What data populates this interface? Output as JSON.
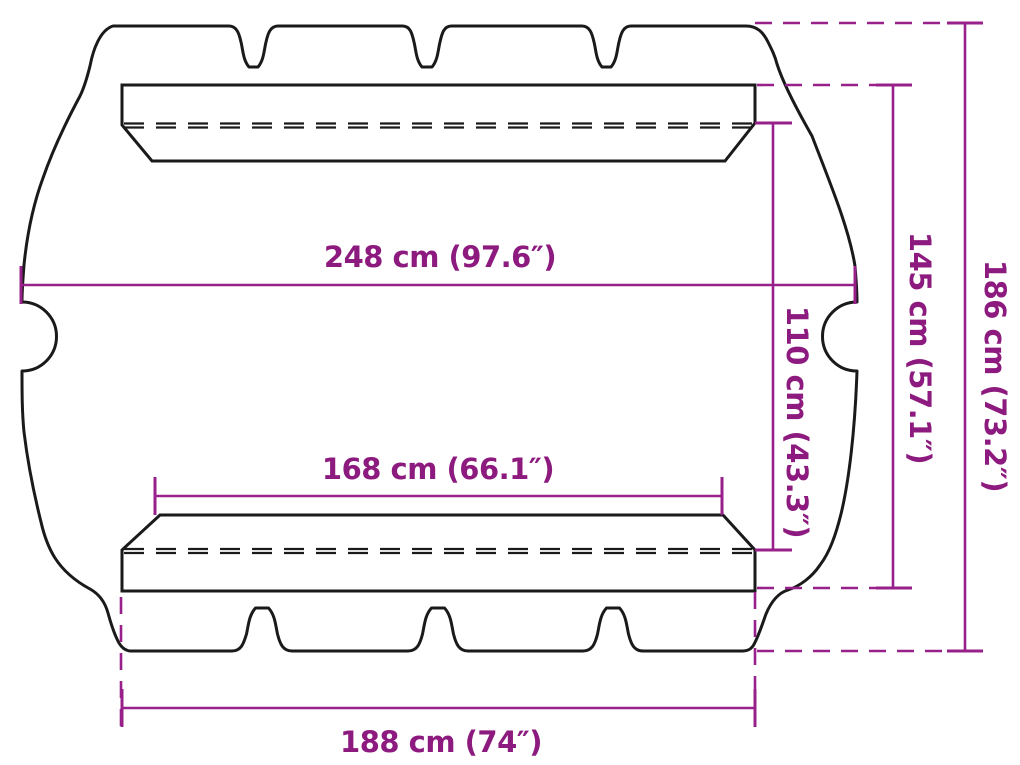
{
  "diagram": {
    "subject": "canopy-top-dimension-drawing",
    "colors": {
      "dimension_lines": "#98208a",
      "dimension_text": "#8d1a7e",
      "outline": "#1a1a1a",
      "background": "#ffffff"
    },
    "labels": {
      "top_width": {
        "text": "248 cm (97.6″)",
        "value_cm": 248,
        "value_in": 97.6
      },
      "mid_width": {
        "text": "168 cm (66.1″)",
        "value_cm": 168,
        "value_in": 66.1
      },
      "bottom_width": {
        "text": "188 cm (74″)",
        "value_cm": 188,
        "value_in": 74
      },
      "inner_height": {
        "text": "110 cm (43.3″)",
        "value_cm": 110,
        "value_in": 43.3
      },
      "mid_height": {
        "text": "145 cm (57.1″)",
        "value_cm": 145,
        "value_in": 57.1
      },
      "outer_height": {
        "text": "186 cm (73.2″)",
        "value_cm": 186,
        "value_in": 73.2
      }
    }
  }
}
